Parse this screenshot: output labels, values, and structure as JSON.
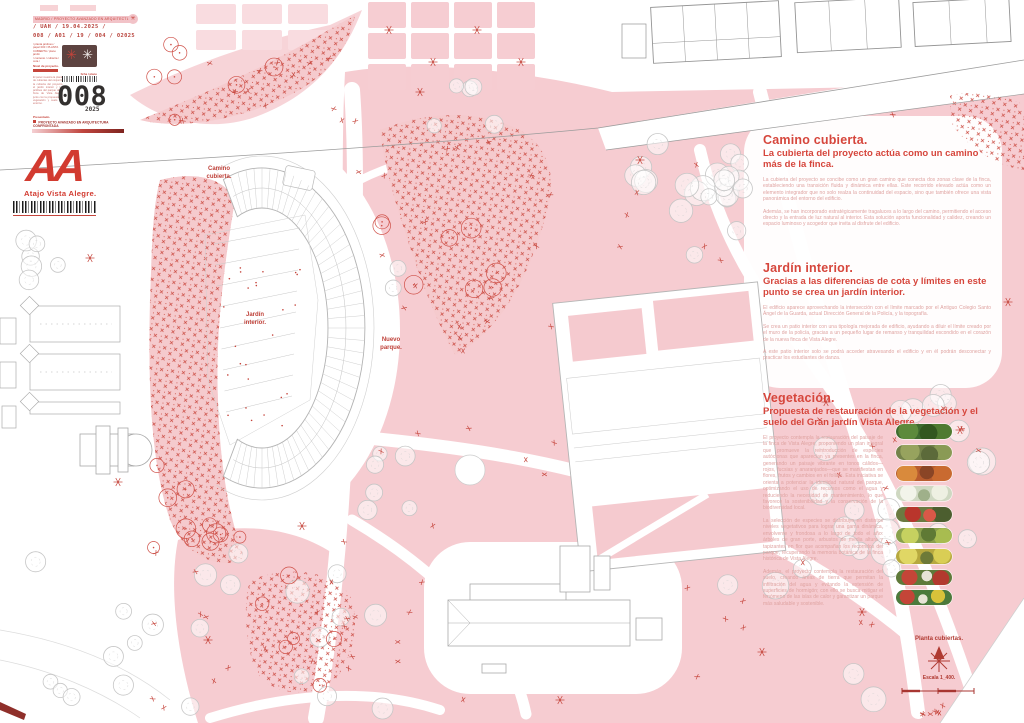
{
  "title_block": {
    "top_strip": "MADRID / PROYECTO AVANZADO EN ARQUITECTURA CONFRONTADA /",
    "strip_icon": "✳",
    "date_line": "/ UAH / 19.04.2025 /",
    "code_line": "008 / A01 / 19 / 004 / 02025",
    "spec_lines": [
      "/ planta jardines /",
      "papel 000 / PLANTA",
      "CUBIERTA / plano jardín",
      "/ contexto / cubierta /",
      "cota /"
    ],
    "level_label": "Nivel de proyecto.",
    "note_text": "El panel muestra la planta de cubiertas del conjunto: la cubierta del proyecto, el jardín interior y los jardines del parque de la finca de Vista Alegre, junto con la propuesta de vegetación y suelo del entorno.",
    "mini_labels": "ficha / plano",
    "sheet_number": "008",
    "sheet_year": "2025",
    "presented_label": "Presentado.",
    "banner_text": "PROYECTO AVANZADO EN ARQUITECTURA CONFRONTADA",
    "logo_text": "AA",
    "project_name": "Atajo Vista Alegre."
  },
  "plan_labels": [
    {
      "text": "Camino\ncubierta."
    },
    {
      "text": "Jardín\ninterior."
    },
    {
      "text": "Nuevo\nparque."
    }
  ],
  "panels": [
    {
      "title": "Camino cubierta.",
      "subtitle": "La cubierta del proyecto actúa como un camino más de la finca.",
      "paragraphs": [
        "La cubierta del proyecto se concibe como un gran camino que conecta dos zonas clave de la finca, estableciendo una transición fluida y dinámica entre ellas. Este recorrido elevado actúa como un elemento integrador que no solo realza la continuidad del espacio, sino que también ofrece una vista panorámica del entorno del edificio.",
        "Además, se han incorporado estratégicamente tragaluces a lo largo del camino, permitiendo el acceso directo y la entrada de luz natural al interior. Esta solución aporta funcionalidad y calidez, creando un espacio luminoso y acogedor que invita al disfrute del edificio."
      ]
    },
    {
      "title": "Jardín interior.",
      "subtitle": "Gracias a las diferencias de cota y límites en este punto se crea un jardín interior.",
      "paragraphs": [
        "El edificio aparece aprovechando la intersección con el límite marcado por el Antiguo Colegio Santo Ángel de la Guarda, actual Dirección General de la Policía, y la topografía.",
        "Se crea un patio interior con una tipología mejorada de edificio, ayudando a diluir el límite creado por el muro de la policía, gracias a un pequeño lugar de remanso y tranquilidad escondido en el corazón de la nueva finca de Vista Alegre.",
        "A este patio interior solo se podrá acceder atravesando el edificio y en él podrán desconectar y practicar los estudiantes de danza."
      ]
    },
    {
      "title": "Vegetación.",
      "subtitle": "Propuesta de restauración de la vegetación y el suelo del Gran jardín Vista Alegre.",
      "paragraphs": [
        "El proyecto contempla la restauración del paisaje de la finca de Vista Alegre, proponiendo un plan integral que promueve la reintroducción de especies autóctonas que aparecían ya presentes en la finca, generando un paisaje vibrante en tonos cálidos—rojos, fucsias y anaranjados—que se manifiestan en flores, frutos y cambios en el follaje. Esta iniciativa se orienta a potenciar la identidad natural del parque, optimizando el uso de recursos como el agua y reduciendo la necesidad de mantenimiento, lo que favorece la sostenibilidad y la conservación de la biodiversidad local.",
        "La selección de especies se distribuye en distintos niveles vegetativos para lograr una gama dinámica, envolvente y frondosa a lo largo de todo el año: árboles de gran porte, arbustos de media altura y tapizantes en flor que acompañan los recorridos del parque, recuperando la memoria botánica de la finca histórica de Vista Alegre.",
        "Además, el proyecto contempla la restauración del suelo, creando áreas de tierra que permitan la infiltración del agua y evitando la extensión de superficies de hormigón; con ello se busca mitigar el fenómeno de las islas de calor y garantizar un parque más saludable y sostenible."
      ],
      "photos": [
        "arbolado-verde",
        "arbustos-olivo",
        "follaje-otonal-naranja",
        "floracion-blanca",
        "flores-rojas",
        "arbustos-verde-amarillo",
        "flores-amarillas",
        "flores-rojas-y-blancas",
        "pradera-floral-mixta"
      ]
    }
  ],
  "map_notes": {
    "plan_title": "Planta cubiertas.",
    "scale_label": "Escala 1_400."
  },
  "colors": {
    "accent_red": "#c5443b",
    "heading_red": "#d6463c",
    "pink_fill": "#f6ccd1",
    "faint_text": "#dfa3a1",
    "dark_square": "#5d4340",
    "gray_line": "#b5b5b5",
    "logo_red": "#d23b30"
  }
}
